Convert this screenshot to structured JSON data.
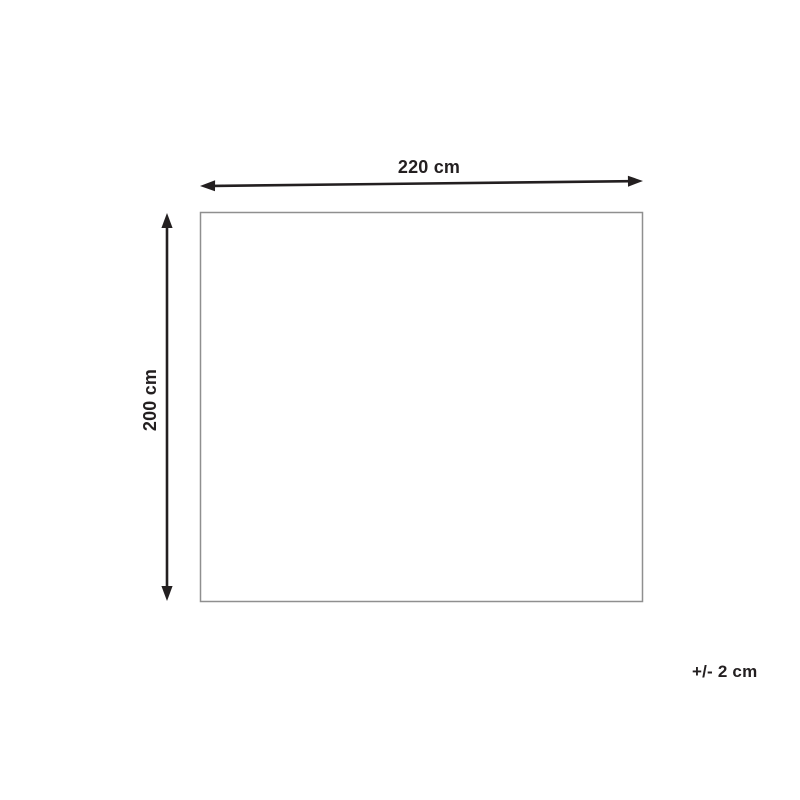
{
  "diagram": {
    "type": "product-dimension-diagram",
    "width_label": "220 cm",
    "height_label": "200 cm",
    "tolerance_label": "+/- 2 cm",
    "colors": {
      "arrow": "#231f20",
      "text": "#231f20",
      "rectangle_border": "#8f8f8f",
      "rectangle_fill": "#ffffff",
      "background": "#ffffff"
    }
  }
}
